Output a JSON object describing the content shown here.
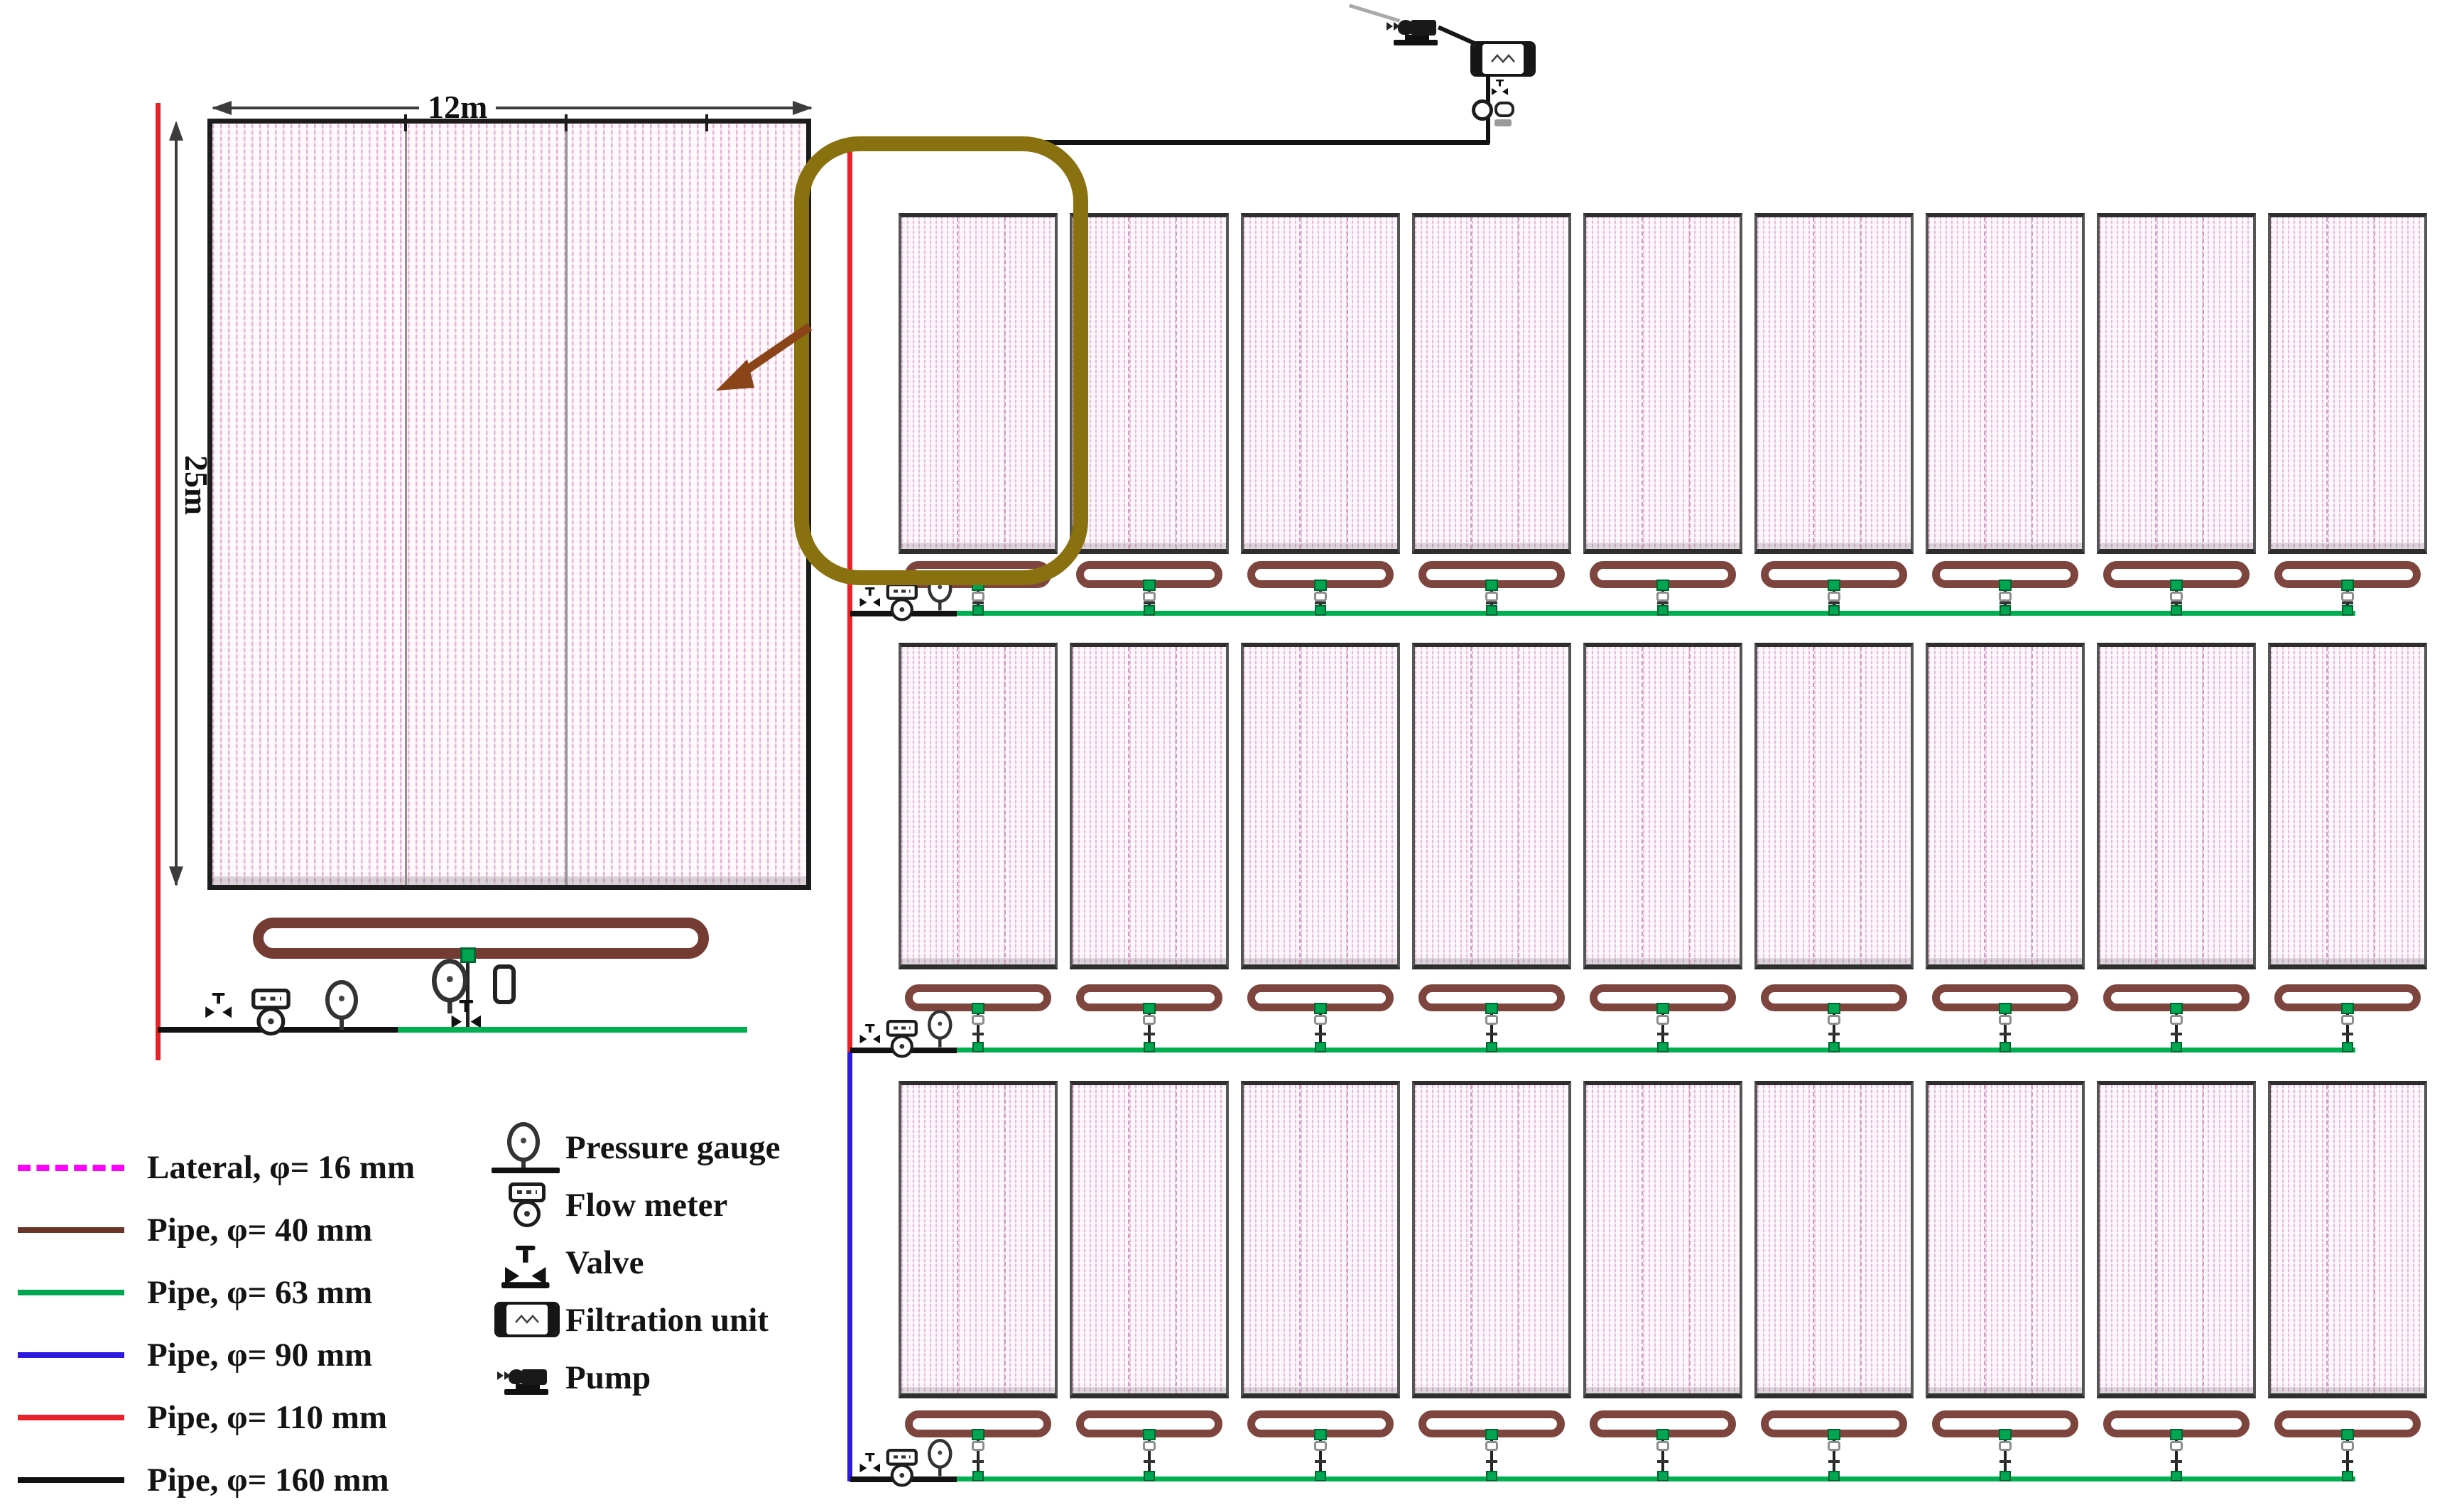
{
  "detail_view": {
    "width_label": "12m",
    "height_label": "25m"
  },
  "legend_pipes": {
    "items": [
      {
        "label": "Lateral, φ= 16 mm",
        "color": "#ff00ff",
        "style": "dashed"
      },
      {
        "label": "Pipe, φ= 40 mm",
        "color": "#6b3428",
        "style": "solid"
      },
      {
        "label": "Pipe, φ= 63 mm",
        "color": "#00a651",
        "style": "solid"
      },
      {
        "label": "Pipe, φ= 90 mm",
        "color": "#2f1bdf",
        "style": "solid"
      },
      {
        "label": "Pipe, φ= 110 mm",
        "color": "#e9222a",
        "style": "solid"
      },
      {
        "label": "Pipe, φ= 160 mm",
        "color": "#111111",
        "style": "solid"
      }
    ]
  },
  "legend_symbols": {
    "items": [
      {
        "label": "Pressure gauge",
        "icon": "pressure-gauge-icon"
      },
      {
        "label": "Flow meter",
        "icon": "flow-meter-icon"
      },
      {
        "label": "Valve",
        "icon": "valve-icon"
      },
      {
        "label": "Filtration unit",
        "icon": "filtration-unit-icon"
      },
      {
        "label": "Pump",
        "icon": "pump-icon"
      }
    ]
  },
  "field_layout": {
    "rows": 3,
    "plots_per_row": 9
  },
  "colors": {
    "lateral": "#ff00ff",
    "pipe_40": "#6b3428",
    "pipe_63": "#00a651",
    "pipe_90": "#2f1bdf",
    "pipe_110": "#e9222a",
    "pipe_160": "#111111",
    "highlight_box": "#8a7110",
    "callout_arrow": "#8a4418"
  }
}
